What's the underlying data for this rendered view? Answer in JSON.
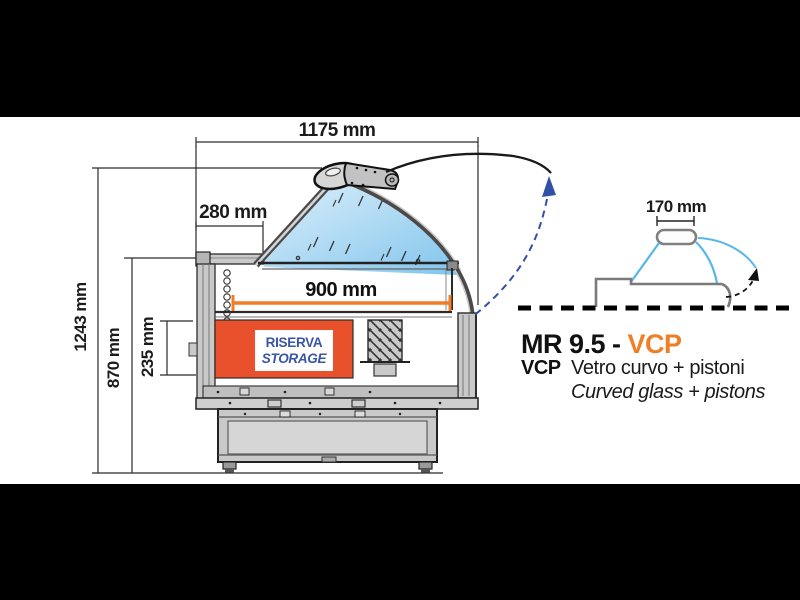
{
  "colors": {
    "accent_orange": "#F07E26",
    "storage_red": "#E8512C",
    "label_blue": "#3A55A8",
    "arc_blue": "#3350A6",
    "cyan_line": "#57B8E8",
    "glass_blue_light": "#DCEFFA",
    "glass_blue_dark": "#82C5ED",
    "drawing_gray": "#C9C9C9",
    "letterbox_black": "#000000"
  },
  "main_drawing": {
    "dimensions": {
      "total_width": "1175 mm",
      "back_top_depth": "280 mm",
      "display_deck_width": "900 mm",
      "storage_height": "235 mm",
      "counter_height": "870 mm",
      "total_height": "1243 mm"
    },
    "storage_label": {
      "line1": "RISERVA",
      "line2": "STORAGE"
    }
  },
  "side_diagram": {
    "handle_width": "170 mm"
  },
  "caption": {
    "model_prefix": "MR 9.5 - ",
    "model_suffix": "VCP",
    "code": "VCP",
    "description_it": "Vetro curvo + pistoni",
    "description_en": "Curved glass + pistons"
  }
}
